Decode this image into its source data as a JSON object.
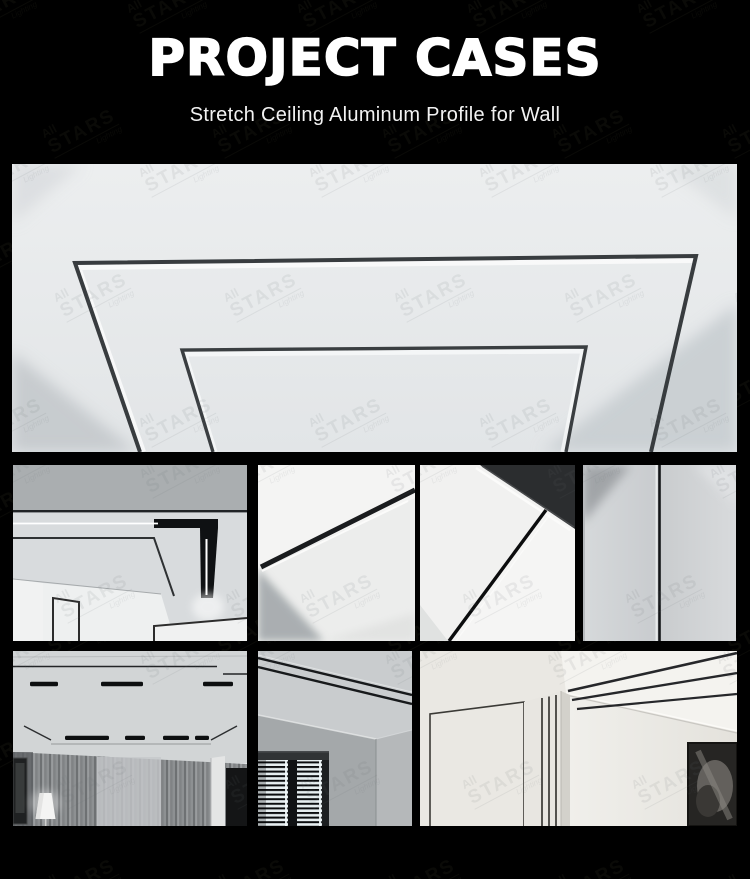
{
  "header": {
    "title": "PROJECT CASES",
    "subtitle": "Stretch Ceiling Aluminum Profile for Wall"
  },
  "watermark": {
    "top": "All",
    "main": "STARS",
    "sub": "Lighting"
  },
  "colors": {
    "background": "#000000",
    "title_text": "#ffffff",
    "subtitle_text": "#f2f2f2",
    "ceiling_light": "#e8eaec",
    "profile_line": "#33373a",
    "led_white": "#ffffff"
  }
}
